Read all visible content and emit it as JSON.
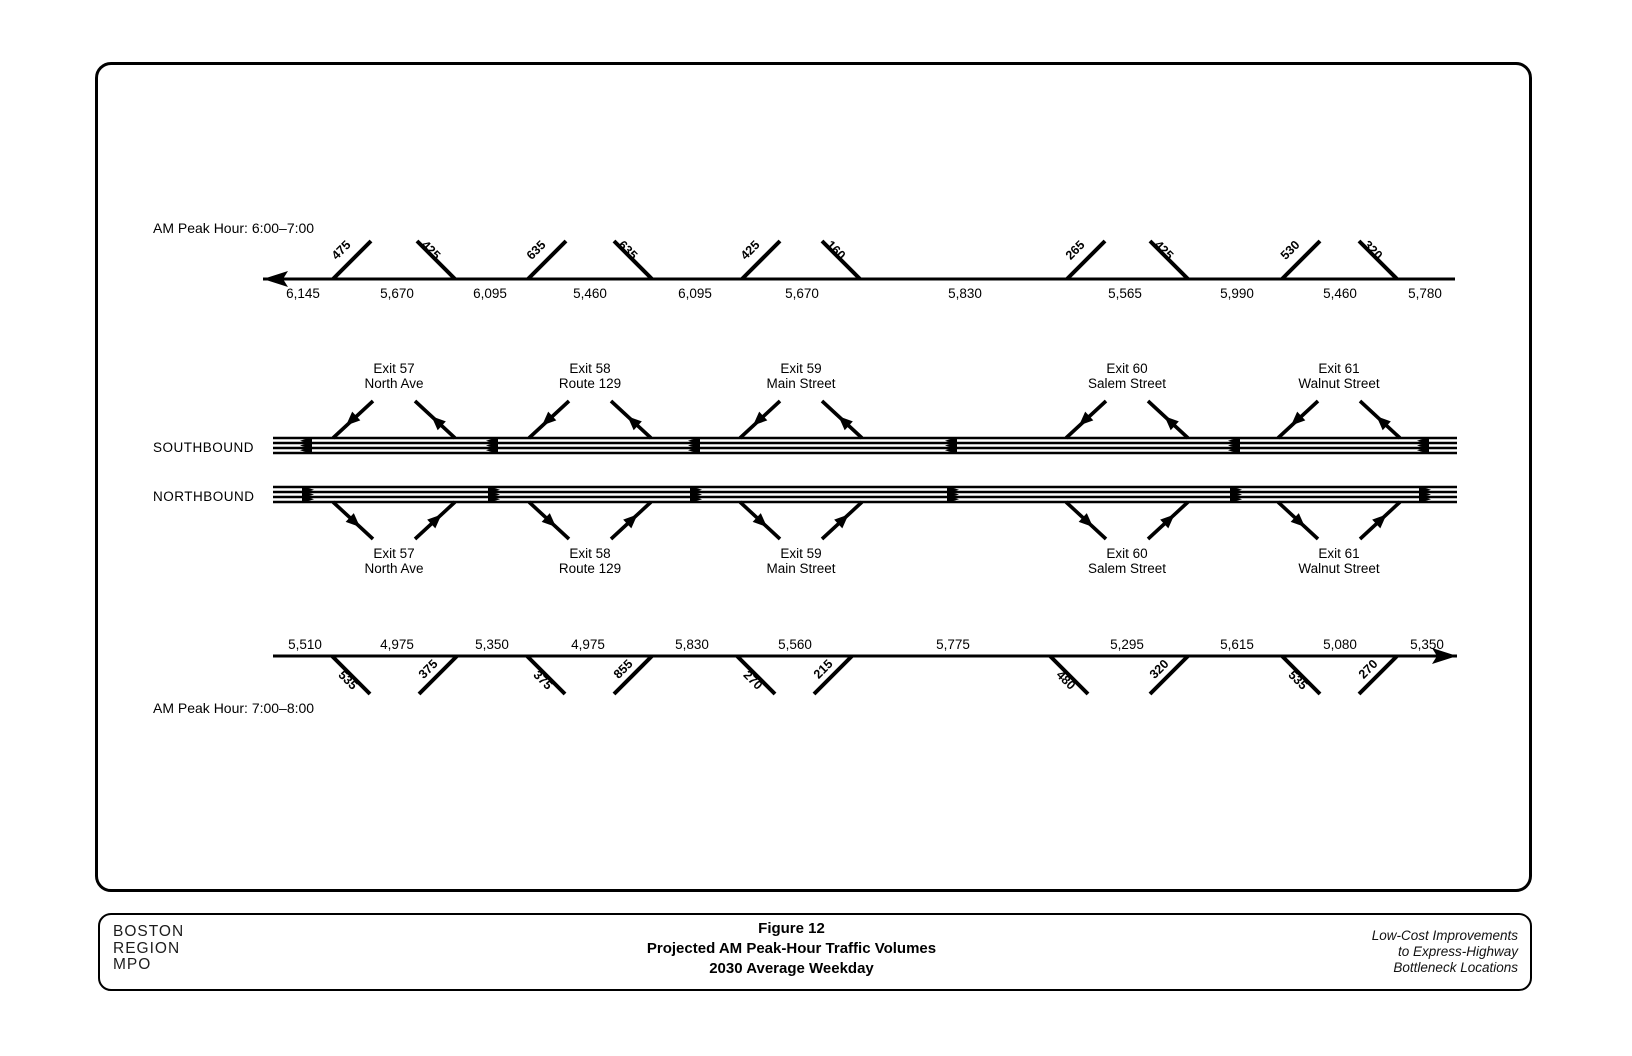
{
  "colors": {
    "ink": "#000000",
    "paper": "#ffffff"
  },
  "diagram": {
    "top_flow": {
      "peak_hour_label": "AM Peak Hour: 6:00–7:00",
      "direction": "left",
      "mainline_volumes": [
        "6,145",
        "5,670",
        "6,095",
        "5,460",
        "6,095",
        "5,670",
        "5,830",
        "5,565",
        "5,990",
        "5,460",
        "5,780"
      ],
      "ramp_volumes": [
        {
          "value": "475",
          "movement": "on"
        },
        {
          "value": "425",
          "movement": "off"
        },
        {
          "value": "635",
          "movement": "on"
        },
        {
          "value": "635",
          "movement": "off"
        },
        {
          "value": "425",
          "movement": "on"
        },
        {
          "value": "160",
          "movement": "off"
        },
        {
          "value": "265",
          "movement": "on"
        },
        {
          "value": "425",
          "movement": "off"
        },
        {
          "value": "530",
          "movement": "on"
        },
        {
          "value": "320",
          "movement": "off"
        }
      ]
    },
    "bottom_flow": {
      "peak_hour_label": "AM Peak Hour: 7:00–8:00",
      "direction": "right",
      "mainline_volumes": [
        "5,510",
        "4,975",
        "5,350",
        "4,975",
        "5,830",
        "5,560",
        "5,775",
        "5,295",
        "5,615",
        "5,080",
        "5,350"
      ],
      "ramp_volumes": [
        {
          "value": "535",
          "movement": "off"
        },
        {
          "value": "375",
          "movement": "on"
        },
        {
          "value": "375",
          "movement": "off"
        },
        {
          "value": "855",
          "movement": "on"
        },
        {
          "value": "270",
          "movement": "off"
        },
        {
          "value": "215",
          "movement": "on"
        },
        {
          "value": "480",
          "movement": "off"
        },
        {
          "value": "320",
          "movement": "on"
        },
        {
          "value": "535",
          "movement": "off"
        },
        {
          "value": "270",
          "movement": "on"
        }
      ]
    },
    "roadways": {
      "southbound_label": "SOUTHBOUND",
      "northbound_label": "NORTHBOUND"
    },
    "exits": [
      {
        "exit": "Exit 57",
        "street": "North Ave"
      },
      {
        "exit": "Exit 58",
        "street": "Route 129"
      },
      {
        "exit": "Exit 59",
        "street": "Main Street"
      },
      {
        "exit": "Exit 60",
        "street": "Salem Street"
      },
      {
        "exit": "Exit 61",
        "street": "Walnut Street"
      }
    ]
  },
  "footer": {
    "org_lines": [
      "BOSTON",
      "REGION",
      "MPO"
    ],
    "title_lines": [
      "Figure 12",
      "Projected AM Peak-Hour Traffic Volumes",
      "2030 Average Weekday"
    ],
    "project_lines": [
      "Low-Cost Improvements",
      "to Express-Highway",
      "Bottleneck Locations"
    ]
  }
}
